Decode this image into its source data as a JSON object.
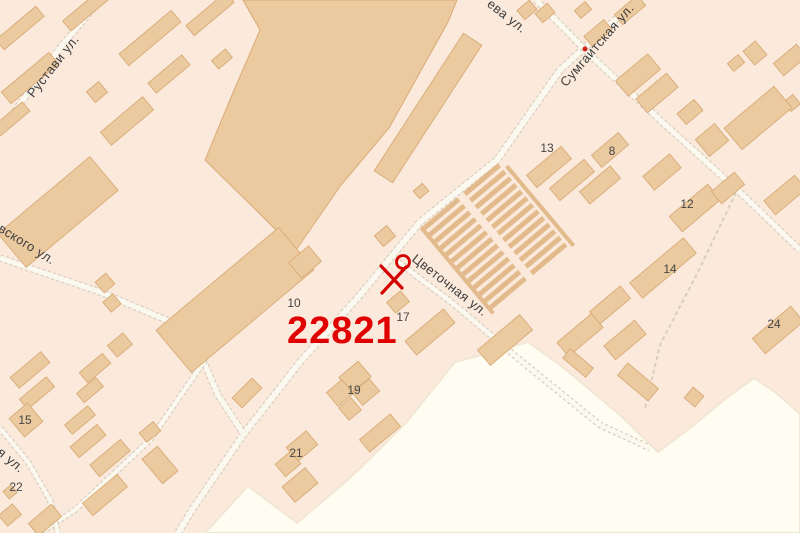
{
  "map": {
    "region_label": "22821",
    "marker": {
      "x": 403,
      "y": 262,
      "r": 6.5,
      "color": "#d40000"
    },
    "poi_dot": {
      "x": 585,
      "y": 49,
      "r": 2.5,
      "color": "#cc2211"
    },
    "street_labels": [
      {
        "text": "Рустави ул.",
        "x": 53,
        "y": 66,
        "rot": -52
      },
      {
        "text": "ева ул.",
        "x": 507,
        "y": 16,
        "rot": 38
      },
      {
        "text": "Сумгаитская ул.",
        "x": 597,
        "y": 45,
        "rot": -49
      },
      {
        "text": "вского ул.",
        "x": 27,
        "y": 244,
        "rot": 32
      },
      {
        "text": "Цветочная ул.",
        "x": 450,
        "y": 285,
        "rot": 38
      },
      {
        "text": "я ул.",
        "x": 11,
        "y": 460,
        "rot": 40
      }
    ],
    "building_numbers": [
      {
        "text": "13",
        "x": 547,
        "y": 148
      },
      {
        "text": "8",
        "x": 612,
        "y": 151
      },
      {
        "text": "12",
        "x": 687,
        "y": 204
      },
      {
        "text": "14",
        "x": 670,
        "y": 269
      },
      {
        "text": "24",
        "x": 774,
        "y": 324
      },
      {
        "text": "10",
        "x": 294,
        "y": 303
      },
      {
        "text": "17",
        "x": 403,
        "y": 317
      },
      {
        "text": "19",
        "x": 354,
        "y": 390
      },
      {
        "text": "21",
        "x": 296,
        "y": 453
      },
      {
        "text": "15",
        "x": 25,
        "y": 420
      },
      {
        "text": "22",
        "x": 16,
        "y": 487
      }
    ],
    "colors": {
      "background": "#fbe9dc",
      "building_fill": "#eccaa0",
      "building_stroke": "#d8ab76",
      "white_zone": "#fffdf2",
      "white_zone_edge": "#f2e6d4",
      "road_casing": "#d6cfc0",
      "road_fill": "#fbf8f0",
      "garage_stripe": "#e2ba8b",
      "street_text": "#3d3d3d",
      "number_text": "#454545",
      "zone_number_red": "#e10000",
      "marker_red": "#d40000"
    },
    "white_zone": [
      [
        205,
        533
      ],
      [
        248,
        486
      ],
      [
        297,
        523
      ],
      [
        350,
        478
      ],
      [
        405,
        424
      ],
      [
        455,
        362
      ],
      [
        500,
        350
      ],
      [
        528,
        342
      ],
      [
        560,
        365
      ],
      [
        620,
        415
      ],
      [
        658,
        452
      ],
      [
        690,
        428
      ],
      [
        724,
        400
      ],
      [
        754,
        378
      ],
      [
        775,
        392
      ],
      [
        800,
        414
      ],
      [
        800,
        533
      ]
    ],
    "roads": [
      {
        "pts": [
          [
            100,
            0
          ],
          [
            60,
            48
          ],
          [
            5,
            125
          ],
          [
            0,
            131
          ]
        ],
        "w": 5
      },
      {
        "pts": [
          [
            637,
            0
          ],
          [
            560,
            70
          ],
          [
            497,
            160
          ],
          [
            420,
            222
          ],
          [
            360,
            295
          ],
          [
            300,
            362
          ],
          [
            243,
            435
          ],
          [
            192,
            510
          ],
          [
            178,
            533
          ]
        ],
        "w": 5.5
      },
      {
        "pts": [
          [
            536,
            0
          ],
          [
            590,
            55
          ],
          [
            660,
            120
          ],
          [
            745,
            197
          ],
          [
            800,
            250
          ]
        ],
        "w": 5
      },
      {
        "pts": [
          [
            0,
            258
          ],
          [
            100,
            292
          ],
          [
            190,
            330
          ],
          [
            218,
            395
          ],
          [
            243,
            433
          ]
        ],
        "w": 5
      },
      {
        "pts": [
          [
            398,
            262
          ],
          [
            455,
            305
          ],
          [
            520,
            360
          ],
          [
            600,
            425
          ],
          [
            650,
            448
          ]
        ],
        "w": 4.5
      },
      {
        "pts": [
          [
            205,
            360
          ],
          [
            150,
            440
          ],
          [
            75,
            510
          ],
          [
            40,
            533
          ]
        ],
        "w": 4
      },
      {
        "pts": [
          [
            0,
            428
          ],
          [
            28,
            462
          ],
          [
            50,
            500
          ],
          [
            58,
            533
          ]
        ],
        "w": 4
      },
      {
        "pts": [
          [
            739,
            186
          ],
          [
            700,
            268
          ],
          [
            660,
            345
          ],
          [
            645,
            408
          ]
        ],
        "w": 2,
        "dashed": true
      }
    ],
    "big_building": [
      [
        243,
        0
      ],
      [
        457,
        0
      ],
      [
        448,
        22
      ],
      [
        389,
        128
      ],
      [
        341,
        185
      ],
      [
        296,
        250
      ],
      [
        256,
        210
      ],
      [
        205,
        160
      ],
      [
        232,
        95
      ],
      [
        260,
        30
      ]
    ],
    "buildings": [
      [
        20,
        28,
        52,
        13,
        -40
      ],
      [
        30,
        78,
        62,
        15,
        -40
      ],
      [
        10,
        120,
        42,
        12,
        -40
      ],
      [
        86,
        10,
        50,
        13,
        -40
      ],
      [
        150,
        38,
        68,
        15,
        -40
      ],
      [
        210,
        14,
        52,
        13,
        -40
      ],
      [
        97,
        92,
        16,
        14,
        -40
      ],
      [
        127,
        121,
        55,
        17,
        -40
      ],
      [
        169,
        74,
        44,
        13,
        -40
      ],
      [
        222,
        59,
        18,
        11,
        -40
      ],
      [
        428,
        108,
        164,
        22,
        -57
      ],
      [
        58,
        212,
        120,
        44,
        -40
      ],
      [
        105,
        283,
        14,
        14,
        -40
      ],
      [
        112,
        303,
        13,
        13,
        -40
      ],
      [
        120,
        345,
        20,
        15,
        -40
      ],
      [
        235,
        300,
        160,
        55,
        -40
      ],
      [
        305,
        262,
        26,
        20,
        -40
      ],
      [
        385,
        236,
        16,
        14,
        -40
      ],
      [
        398,
        302,
        18,
        14,
        -40
      ],
      [
        430,
        332,
        50,
        18,
        -40
      ],
      [
        505,
        340,
        55,
        20,
        -40
      ],
      [
        421,
        191,
        12,
        10,
        -40
      ],
      [
        549,
        167,
        45,
        16,
        -40
      ],
      [
        572,
        180,
        45,
        16,
        -40
      ],
      [
        545,
        13,
        16,
        12,
        -40
      ],
      [
        583,
        10,
        14,
        10,
        -40
      ],
      [
        630,
        10,
        30,
        13,
        -40
      ],
      [
        598,
        33,
        26,
        13,
        -40
      ],
      [
        527,
        10,
        16,
        12,
        -40
      ],
      [
        638,
        75,
        42,
        20,
        -40
      ],
      [
        657,
        93,
        40,
        18,
        -40
      ],
      [
        736,
        63,
        14,
        10,
        -40
      ],
      [
        755,
        53,
        16,
        18,
        -40
      ],
      [
        790,
        60,
        30,
        16,
        -40
      ],
      [
        792,
        103,
        12,
        12,
        -40
      ],
      [
        758,
        118,
        65,
        28,
        -40
      ],
      [
        690,
        112,
        22,
        14,
        -40
      ],
      [
        712,
        140,
        25,
        22,
        -40
      ],
      [
        610,
        150,
        35,
        16,
        -40
      ],
      [
        600,
        185,
        40,
        16,
        -40
      ],
      [
        662,
        172,
        35,
        18,
        -40
      ],
      [
        785,
        195,
        40,
        18,
        -40
      ],
      [
        695,
        208,
        50,
        20,
        -40
      ],
      [
        728,
        188,
        30,
        16,
        -40
      ],
      [
        663,
        268,
        70,
        20,
        -40
      ],
      [
        610,
        305,
        40,
        16,
        -40
      ],
      [
        580,
        335,
        45,
        18,
        -40
      ],
      [
        625,
        340,
        40,
        18,
        -40
      ],
      [
        778,
        330,
        50,
        20,
        -40
      ],
      [
        30,
        370,
        40,
        14,
        -40
      ],
      [
        95,
        368,
        30,
        13,
        -40
      ],
      [
        37,
        393,
        35,
        13,
        -40
      ],
      [
        90,
        390,
        25,
        12,
        -40
      ],
      [
        26,
        420,
        24,
        24,
        -40
      ],
      [
        80,
        420,
        30,
        12,
        -40
      ],
      [
        88,
        441,
        35,
        14,
        -40
      ],
      [
        110,
        458,
        40,
        15,
        -40
      ],
      [
        105,
        495,
        45,
        16,
        -40
      ],
      [
        45,
        520,
        30,
        16,
        -40
      ],
      [
        10,
        515,
        18,
        14,
        -40
      ],
      [
        10,
        492,
        10,
        10,
        -40
      ],
      [
        150,
        432,
        18,
        12,
        -40
      ],
      [
        160,
        465,
        20,
        32,
        -40
      ],
      [
        247,
        393,
        28,
        14,
        -45
      ],
      [
        355,
        377,
        25,
        20,
        -40
      ],
      [
        340,
        393,
        20,
        18,
        -40
      ],
      [
        366,
        392,
        22,
        16,
        -40
      ],
      [
        350,
        409,
        16,
        16,
        -40
      ],
      [
        380,
        433,
        40,
        16,
        -40
      ],
      [
        302,
        446,
        26,
        18,
        -40
      ],
      [
        288,
        464,
        20,
        16,
        -40
      ],
      [
        300,
        485,
        30,
        20,
        -40
      ],
      [
        638,
        382,
        40,
        16,
        40
      ],
      [
        578,
        363,
        30,
        12,
        40
      ],
      [
        694,
        397,
        14,
        14,
        40
      ]
    ],
    "garages": {
      "cx": 497,
      "cy": 237,
      "w": 100,
      "h": 112,
      "rot": -40,
      "cols": 2,
      "rows": 13
    }
  }
}
